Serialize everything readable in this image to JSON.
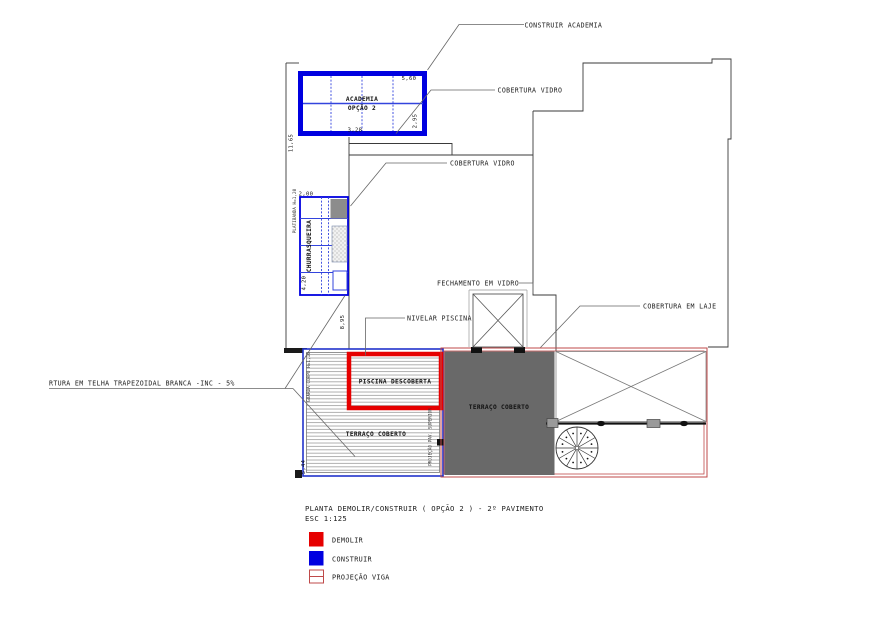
{
  "colors": {
    "construir": "#0000e0",
    "demolir": "#e60000",
    "viga": "#bf4a4a",
    "terrace_fill": "#696969"
  },
  "annotations": {
    "construir_academia": "CONSTRUIR ACADEMIA",
    "cobertura_vidro_top": "COBERTURA VIDRO",
    "cobertura_vidro_mid": "COBERTURA VIDRO",
    "fechamento_vidro": "FECHAMENTO EM VIDRO",
    "nivelar_piscina": "NIVELAR PISCINA",
    "cobertura_laje": "COBERTURA EM LAJE",
    "telha_trapezoidal": "RTURA EM TELHA TRAPEZOIDAL BRANCA -INC - 5%"
  },
  "rooms": {
    "academia": "ACADEMIA",
    "academia_opcao": "OPÇÃO 2",
    "churrasqueira": "CHURRASQUEIRA",
    "piscina": "PISCINA DESCOBERTA",
    "terraco_esq": "TERRAÇO COBERTO",
    "terraco_dir": "TERRAÇO COBERTO",
    "platibanda": "PLATIBANDA H=1,20",
    "guarda_corpo": "GUARDA CORPO H=1,10",
    "projecao_pav_superior": "PROJEÇÃO PAV. SUPERIOR"
  },
  "dimensions": {
    "academia_largura": "5,60",
    "academia_vao": "3,28",
    "academia_altura": "2,95",
    "parede_esquerda": "11,65",
    "churrasqueira_largura": "2,00",
    "churrasqueira_altura": "4,20",
    "corredor": "8,95",
    "terraco_altura": "5,44"
  },
  "titleblock": {
    "title": "PLANTA DEMOLIR/CONSTRUIR ( OPÇÃO 2 ) - 2º PAVIMENTO",
    "scale": "ESC 1:125"
  },
  "legend": {
    "demolir": "DEMOLIR",
    "construir": "CONSTRUIR",
    "projecao_viga": "PROJEÇÃO VIGA"
  }
}
